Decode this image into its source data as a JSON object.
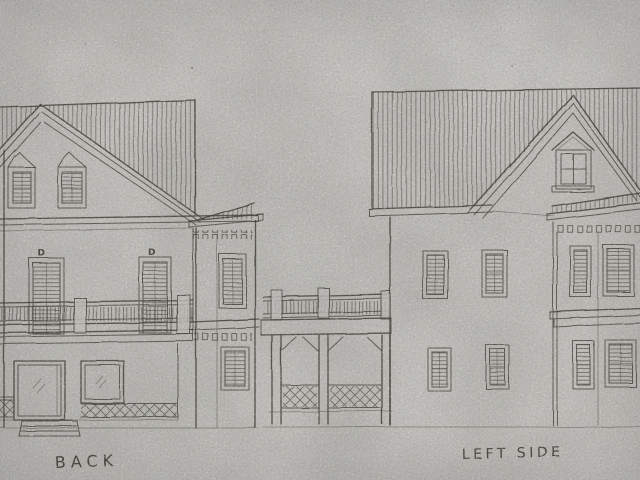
{
  "drawing": {
    "type": "hand-drawn architectural elevation sketch",
    "paper_color": "#c7c6c2",
    "ink_color": "#45413a",
    "elevations": [
      {
        "id": "back",
        "label": "BACK",
        "annotations": [
          "D",
          "D"
        ]
      },
      {
        "id": "left-side",
        "label": "LEFT SIDE",
        "annotations": []
      }
    ]
  }
}
